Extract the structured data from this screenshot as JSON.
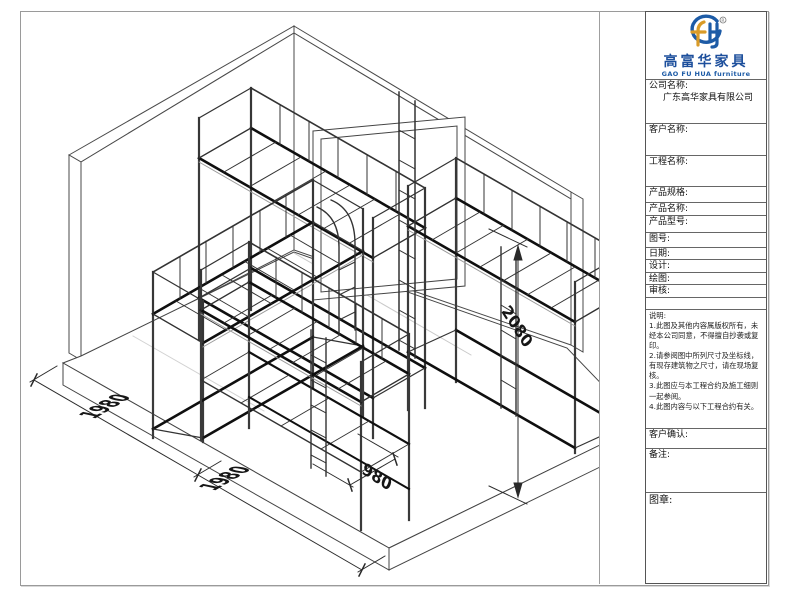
{
  "title_block": {
    "logo": {
      "cn": "高富华家具",
      "en": "GAO FU HUA furniture",
      "registered_mark": "®"
    },
    "fields": [
      {
        "label": "公司名称:",
        "value": "广东高华家具有限公司"
      },
      {
        "label": "客户名称:",
        "value": ""
      },
      {
        "label": "工程名称:",
        "value": ""
      },
      {
        "label": "产品规格:",
        "value": ""
      },
      {
        "label": "产品名称:",
        "value": ""
      },
      {
        "label": "产品型号:",
        "value": ""
      },
      {
        "label": "图号:",
        "value": ""
      },
      {
        "label": "日期:",
        "value": ""
      },
      {
        "label": "设计:",
        "value": ""
      },
      {
        "label": "绘图:",
        "value": ""
      },
      {
        "label": "审核:",
        "value": ""
      }
    ],
    "notes": {
      "label": "说明:",
      "items": [
        "1.此图及其他内容属版权所有，未经本公司同意，不得擅自抄袭或复印。",
        "2.请参阅图中所列尺寸及坐标线，有现存建筑物之尺寸，请在现场复核。",
        "3.此图应与本工程合约及施工细则一起参阅。",
        "4.此图内容与以下工程合约有关。"
      ]
    },
    "confirm_label": "客户确认:",
    "remarks_label": "备注:",
    "seal_label": "图章:"
  },
  "drawing": {
    "type": "isometric furniture layout - dormitory loft beds in room corner",
    "dimensions": {
      "floor_left_a": "1980",
      "floor_left_b": "1980",
      "floor_right": "980",
      "bed_height": "2080"
    }
  },
  "colors": {
    "logo_blue": "#1d5ba6",
    "logo_gold": "#d99b28",
    "line_dark": "#222222",
    "frame_gray": "#9a9a9a"
  }
}
